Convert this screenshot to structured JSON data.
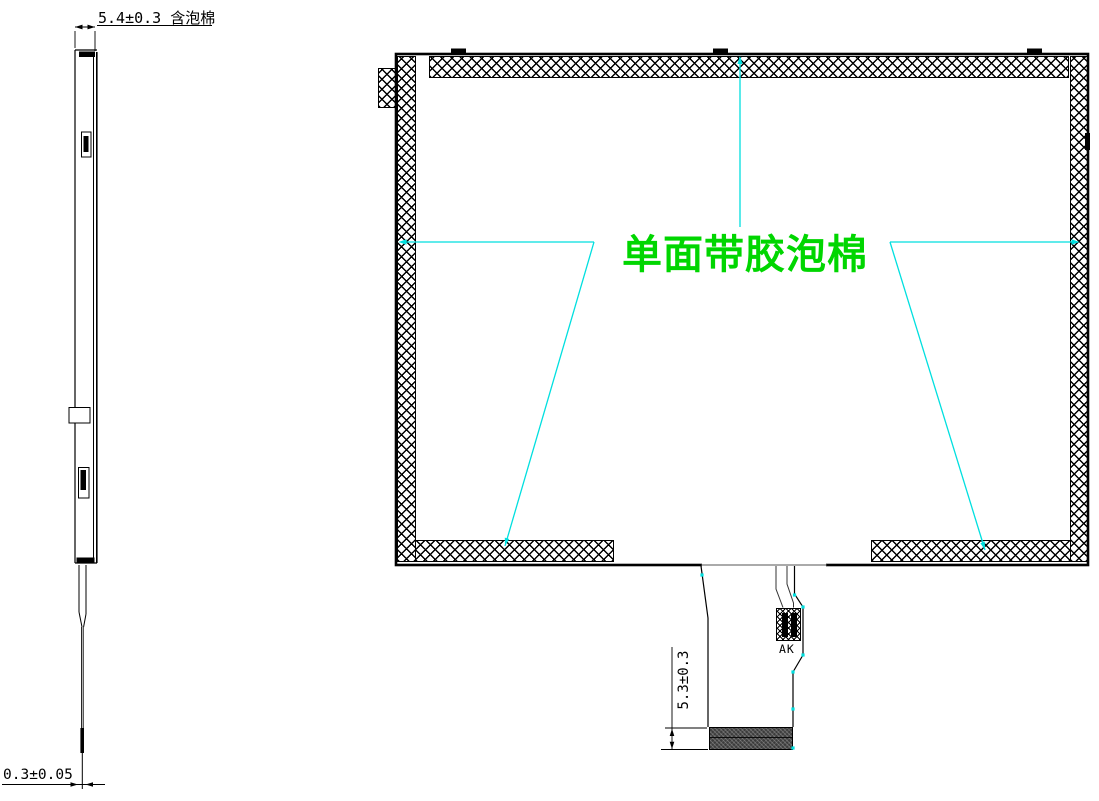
{
  "annotations": {
    "side_thickness_dim": "5.4±0.3 含泡棉",
    "film_thickness_dim": "0.3±0.05",
    "foam_label": "单面带胶泡棉",
    "fpc_stiffener_dim": "5.3±0.3",
    "connector_label": "AK"
  },
  "colors": {
    "line": "#000000",
    "leader": "#00dfdf",
    "foam_text": "#00d600",
    "stiffener_fill": "#3c3c3c"
  }
}
